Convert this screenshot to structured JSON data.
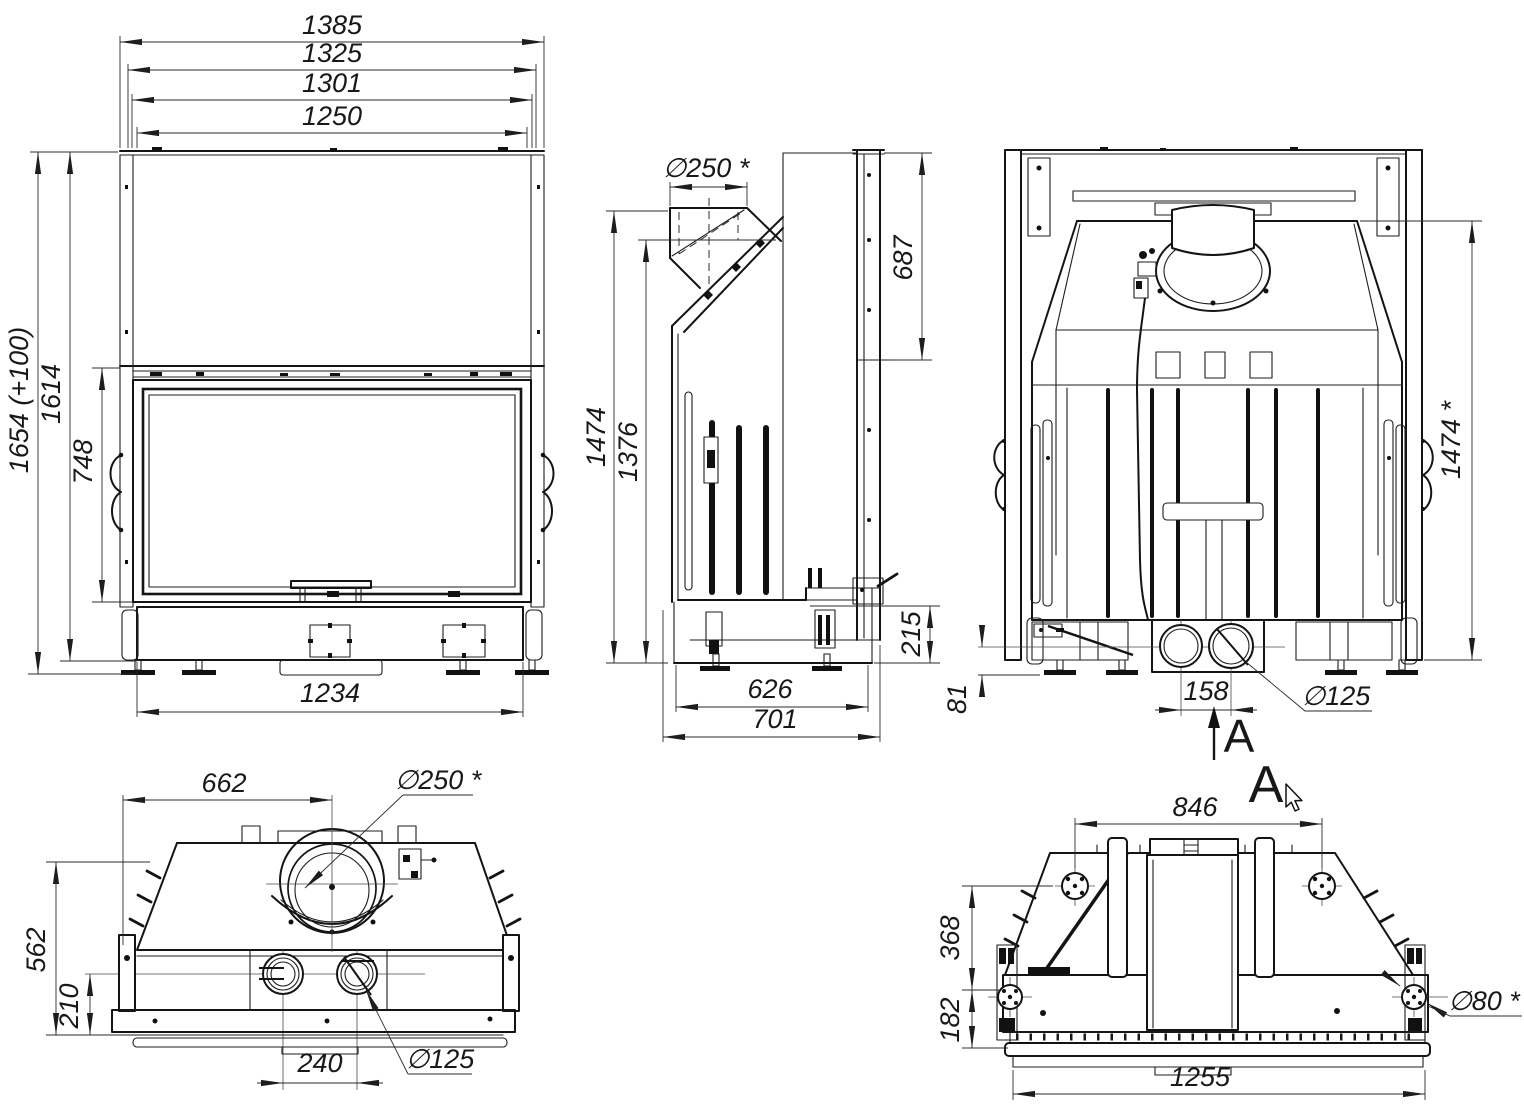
{
  "drawing": {
    "type": "engineering-orthographic-views",
    "subject": "fireplace insert / furnace unit",
    "background": "#ffffff",
    "line_color": "#141414",
    "dim_color": "#2b2b2b",
    "views": {
      "front": {
        "dims": {
          "width_overall": "1385",
          "width_frame": "1325",
          "width_mid": "1301",
          "width_opening": "1250",
          "height_overall": "1654 (+100)",
          "height_body": "1614",
          "door_height": "748",
          "base_width": "1234"
        }
      },
      "side": {
        "dims": {
          "flue_diameter": "∅250 *",
          "rear_panel_height": "687",
          "height_total": "1474",
          "height_front": "1376",
          "base_height": "215",
          "depth_base": "626",
          "depth_overall": "701"
        }
      },
      "rear": {
        "section_arrow": "A",
        "dims": {
          "height_total": "1474 *",
          "foot_height": "81",
          "port_spacing": "158",
          "port_diameter": "∅125"
        }
      },
      "top": {
        "dims": {
          "flue_offset": "662",
          "flue_diameter": "∅250 *",
          "depth": "562",
          "port_offset": "210",
          "port_spacing": "240",
          "port_diameter": "∅125"
        }
      },
      "section": {
        "title": "A",
        "dims": {
          "flange_spacing": "846",
          "depth_upper": "368",
          "depth_lower": "182",
          "width": "1255",
          "flange_diameter": "∅80 *"
        }
      }
    }
  }
}
